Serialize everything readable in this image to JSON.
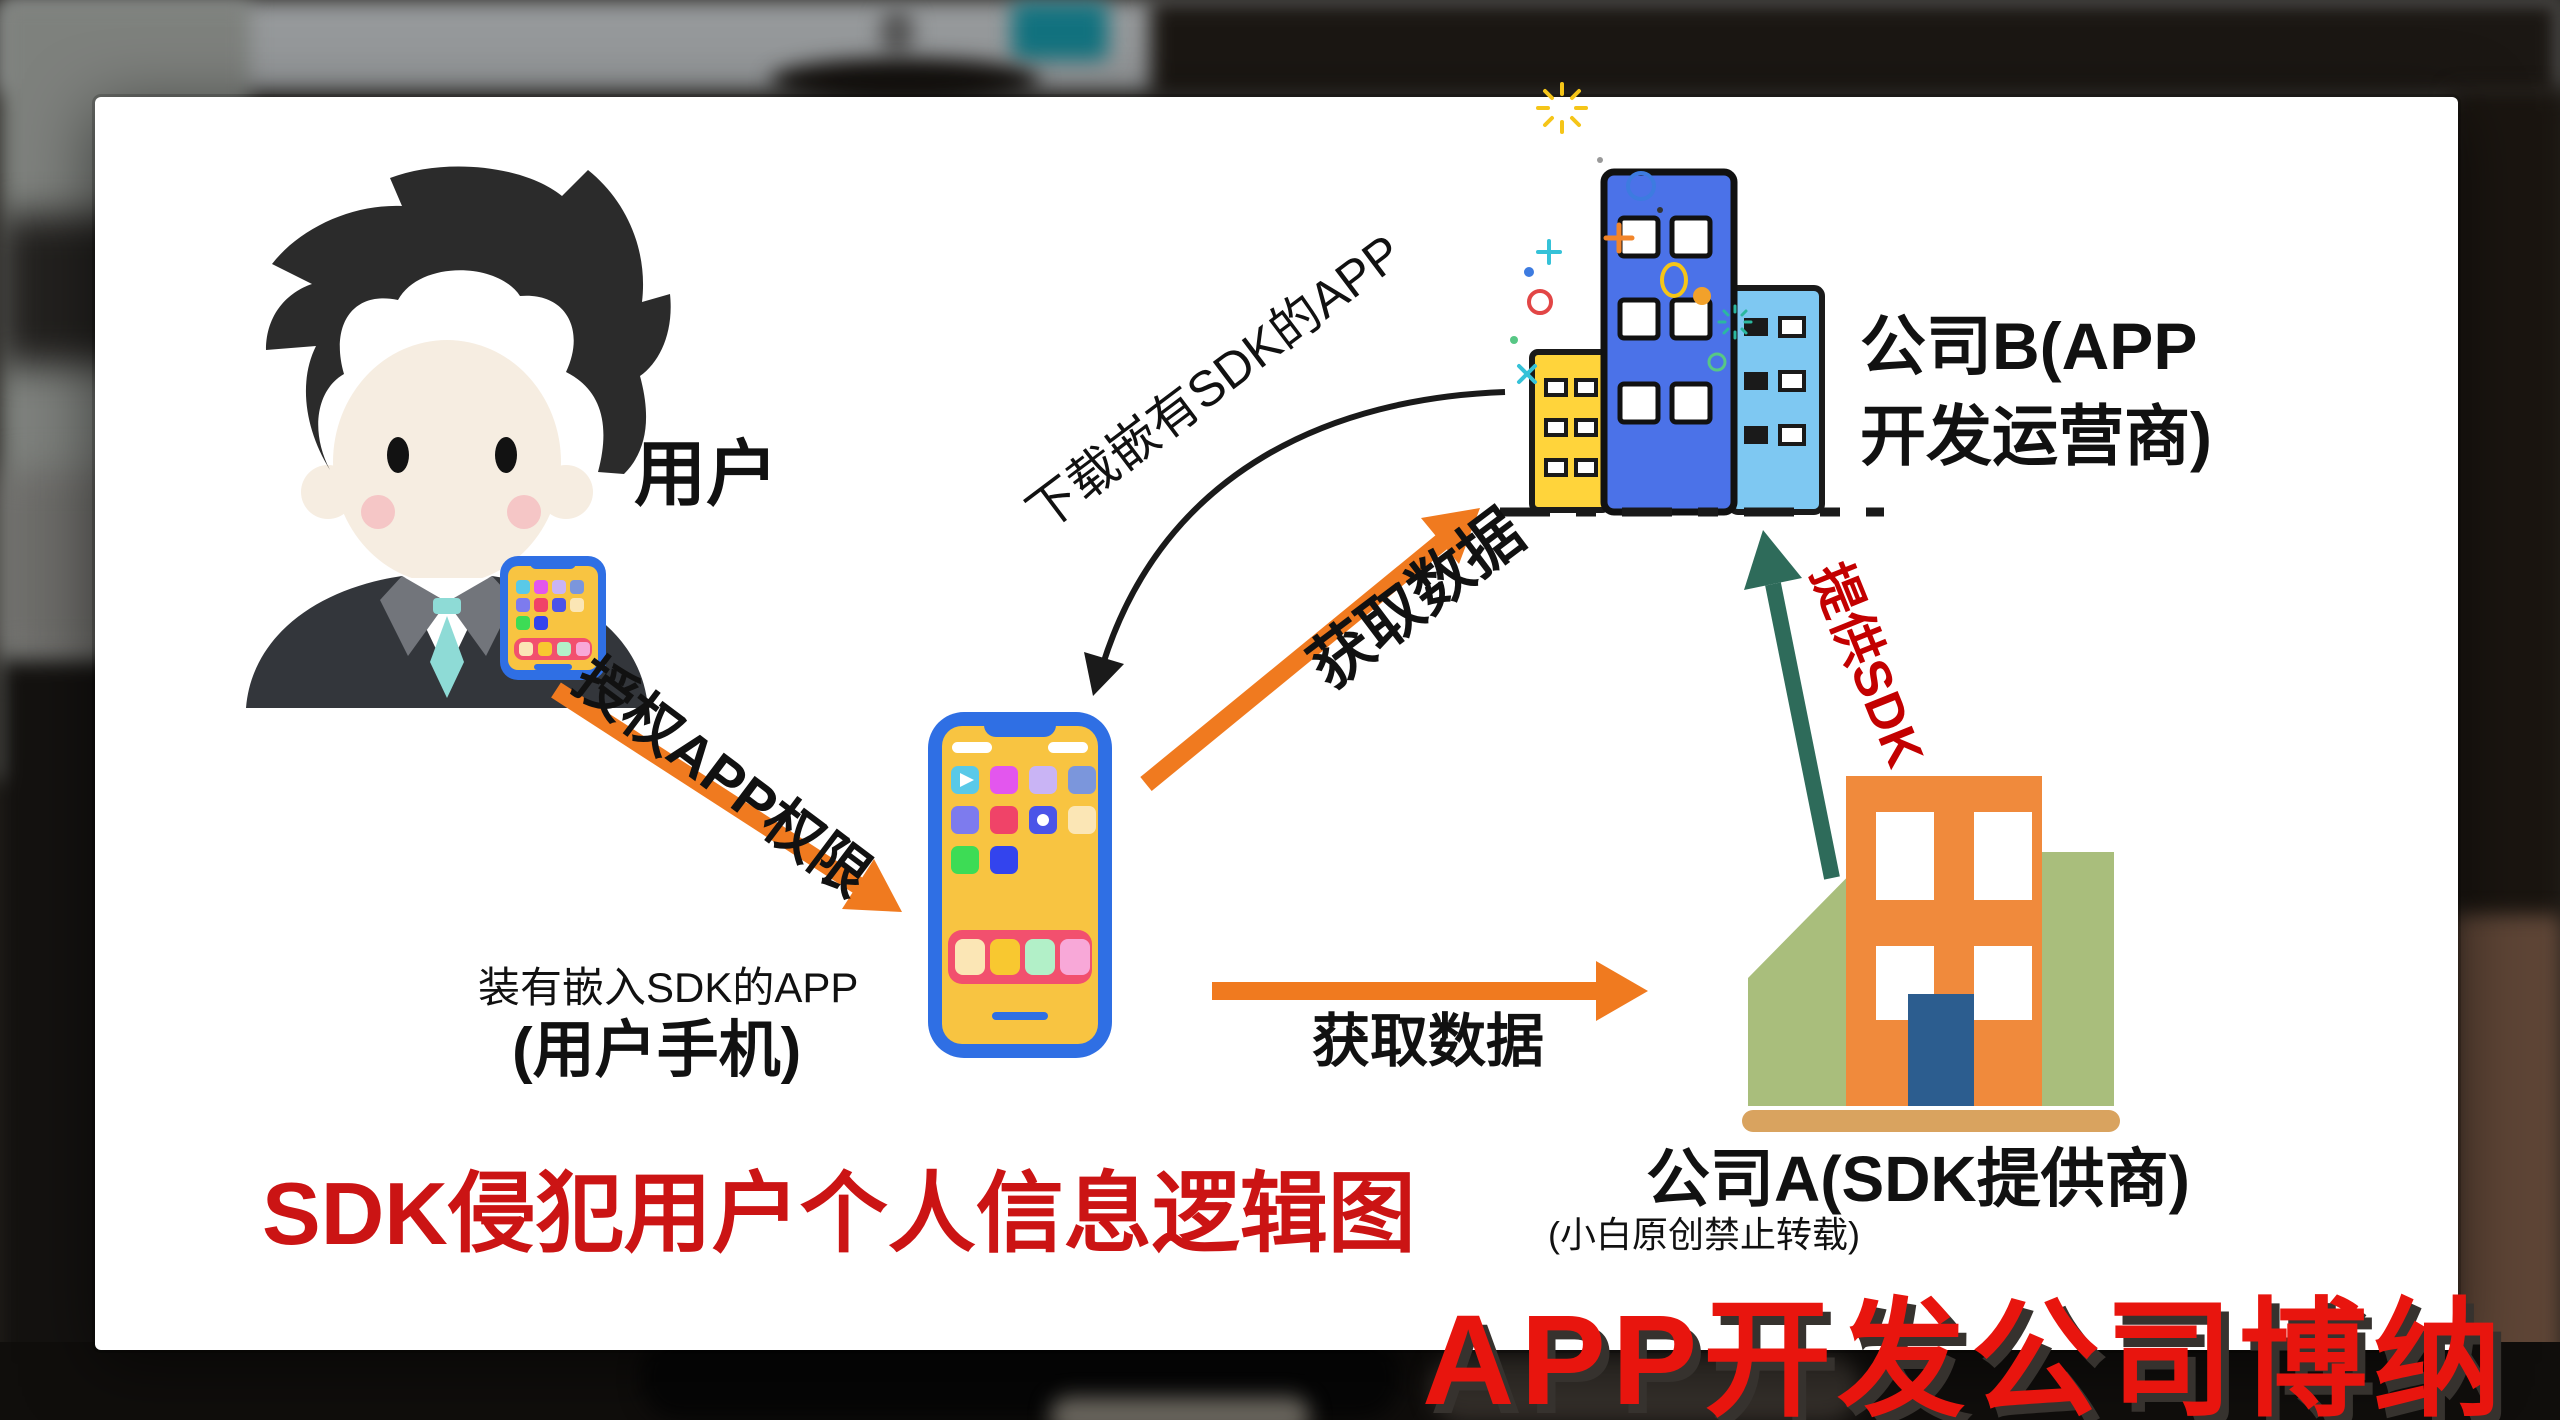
{
  "canvas": {
    "width": 2560,
    "height": 1420
  },
  "colors": {
    "card_background": "#FFFFFF",
    "title_red": "#CB1414",
    "watermark_red": "#E8150E",
    "provide_sdk_red": "#C30000",
    "arrow_orange": "#F07A1F",
    "arrow_green": "#2E6B5A",
    "arrow_black": "#1A1A1A",
    "phone_frame_blue": "#2F6FE4",
    "phone_screen_yellow": "#F8C441",
    "building_b_main_blue": "#4B72E8",
    "building_b_left_yellow": "#FFD43B",
    "building_b_right_lightblue": "#7EC8F2",
    "building_a_orange": "#F08A3C",
    "building_a_green": "#A9BE7C",
    "building_a_door_blue": "#2C5D8F",
    "building_a_ground_tan": "#D9A35F"
  },
  "nodes": {
    "user_label": "用户",
    "user_phone_caption_line1": "装有嵌入SDK的APP",
    "user_phone_caption_line2": "(用户手机)",
    "company_b_label_line1": "公司B(APP",
    "company_b_label_line2": "开发运营商)",
    "company_a_label": "公司A(SDK提供商)"
  },
  "edges": {
    "authorize_app_permission": "授权APP权限",
    "download_sdk_app": "下载嵌有SDK的APP",
    "get_data_to_company_b": "获取数据",
    "get_data_to_company_a": "获取数据",
    "provide_sdk": "提供SDK"
  },
  "footer": {
    "title": "SDK侵犯用户个人信息逻辑图",
    "title_note": "(小白原创禁止转载)",
    "watermark": "APP开发公司博纳"
  }
}
